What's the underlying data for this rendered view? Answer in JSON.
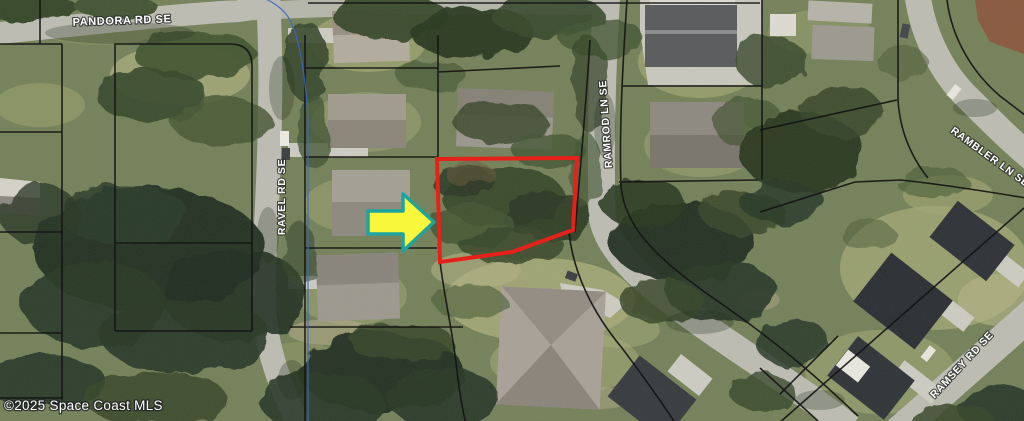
{
  "map": {
    "street_labels": [
      {
        "name": "pandora-rd-se",
        "text": "PANDORA RD SE"
      },
      {
        "name": "ravel-rd-se",
        "text": "RAVEL RD SE"
      },
      {
        "name": "ramrod-ln-se",
        "text": "RAMROD LN SE"
      },
      {
        "name": "rambler-ln-se",
        "text": "RAMBLER LN SE"
      },
      {
        "name": "ramsey-rd-se",
        "text": "RAMSEY RD SE"
      }
    ],
    "copyright": "©2025 Space Coast MLS",
    "colors": {
      "subject_parcel_outline": "#e62119",
      "arrow_fill": "#f9f73b",
      "arrow_outline": "#1fa39d",
      "road": "#bdbdb3",
      "parcel_line": "#151515",
      "utility_line": "#3a66cc",
      "label_text": "#ffffff"
    }
  }
}
